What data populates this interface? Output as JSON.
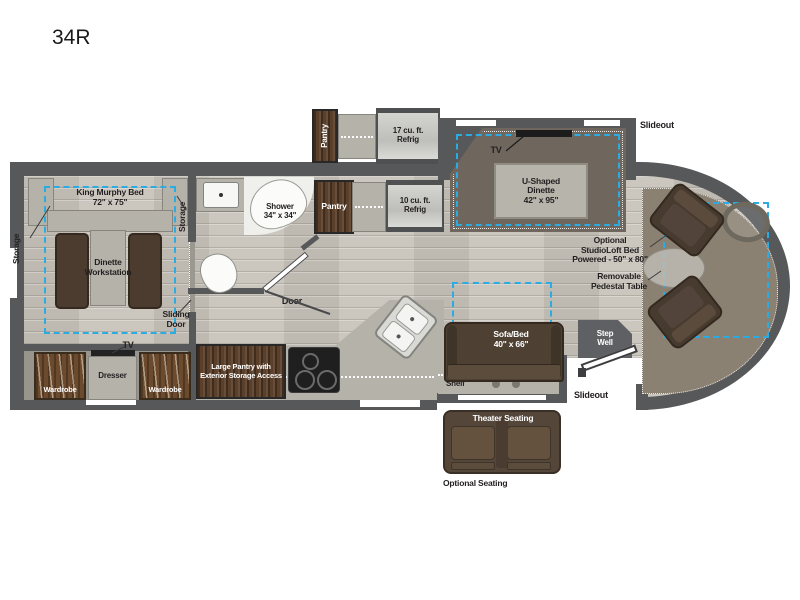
{
  "title": "34R",
  "colors": {
    "wall": "#57585a",
    "floor": "#c9c5bd",
    "slide_dash": "#2aabe2",
    "wood": "#5a3f2a",
    "furniture_brown": "#4e4134",
    "counter": "#b5b2aa",
    "text": "#231f20"
  },
  "labels": {
    "bedroom": {
      "storage_left": "Storage",
      "king_bed": "King Murphy Bed\n72\" x 75\"",
      "dinette": "Dinette\nWorkstation",
      "storage_right": "Storage",
      "sliding_door": "Sliding\nDoor",
      "tv": "TV",
      "wardrobe_left": "Wardrobe",
      "dresser": "Dresser",
      "wardrobe_right": "Wardrobe"
    },
    "bath": {
      "shower": "Shower\n34\" x 34\"",
      "pantry": "Pantry",
      "door": "Door"
    },
    "kitchen": {
      "pantry_optional": "Pantry",
      "refrig_17": "17 cu. ft.\nRefrig",
      "refrig_10": "10 cu. ft.\nRefrig",
      "large_pantry": "Large Pantry with\nExterior Storage Access",
      "shelf": "Shelf"
    },
    "living": {
      "tv": "TV",
      "u_dinette": "U-Shaped\nDinette\n42\" x 95\"",
      "slideout_top": "Slideout",
      "sofa": "Sofa/Bed\n40\" x 66\"",
      "slideout_bottom": "Slideout",
      "step_well": "Step\nWell",
      "theater": "Theater Seating",
      "optional_seating": "Optional Seating"
    },
    "cab": {
      "studioloft": "Optional\nStudioLoft Bed\nPowered - 50\" x 80\"",
      "pedestal": "Removable\nPedestal Table"
    }
  }
}
